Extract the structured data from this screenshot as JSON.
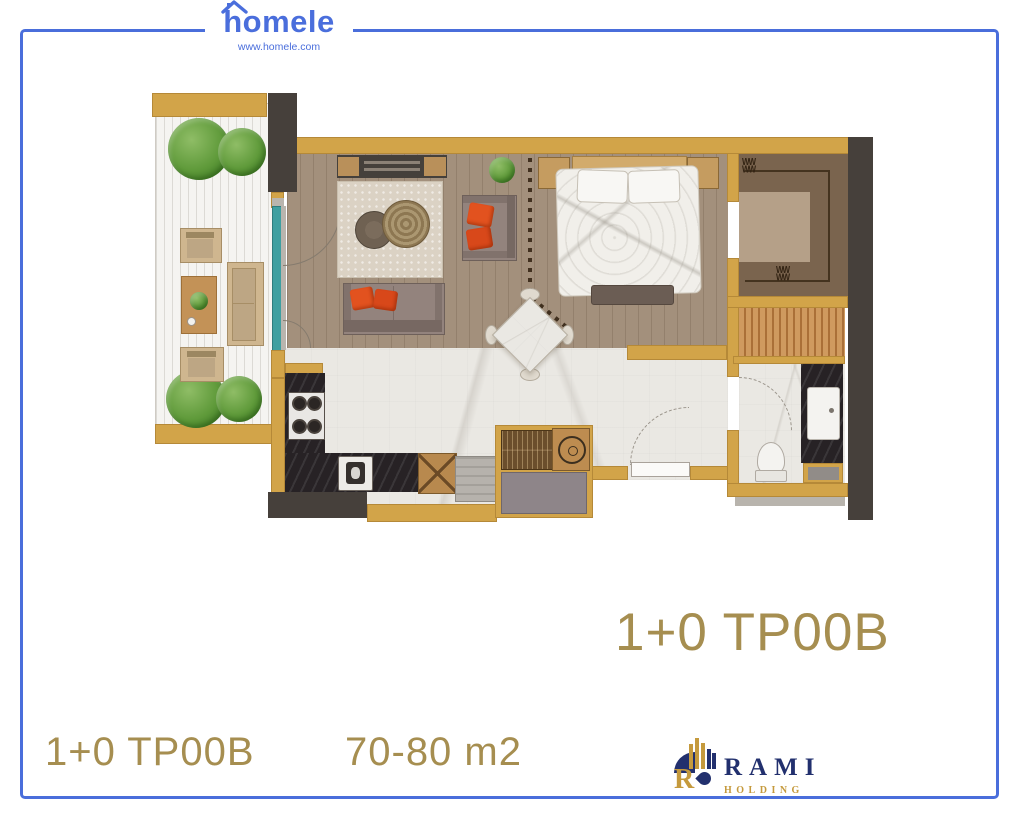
{
  "header": {
    "brand": "homele",
    "website": "www.homele.com"
  },
  "plan_label": {
    "code": "1+0 TP00B"
  },
  "footer": {
    "code": "1+0 TP00B",
    "area": "70-80 m2"
  },
  "rami_logo": {
    "monogram": "R",
    "name": "RAMI",
    "subtitle": "HOLDING"
  },
  "decor": {
    "hanger_glyph": "WW\nWW"
  },
  "colors": {
    "border_blue": "#4a6edb",
    "brand_blue": "#4a6edc",
    "gold_text": "#a68e50",
    "wall_tan": "#d2a449",
    "wall_dark": "#46403b",
    "window_teal": "#3f9fa0",
    "pillow_orange": "#e2521f",
    "rami_navy": "#22306e",
    "rami_gold": "#c59a3d"
  }
}
